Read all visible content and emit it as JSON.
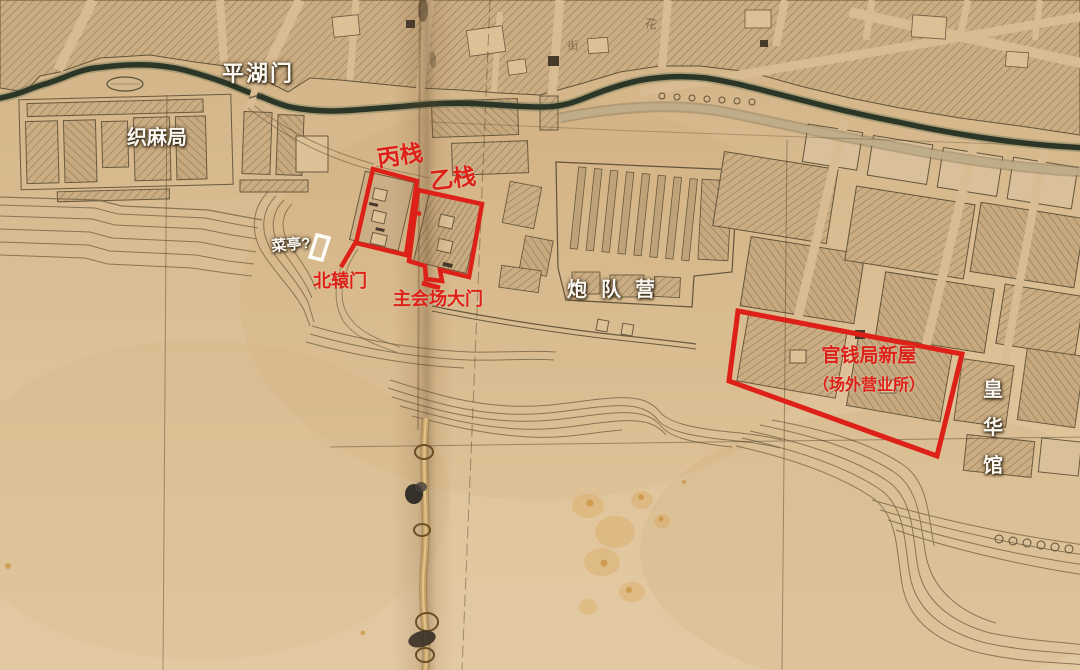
{
  "map": {
    "description": "annotated historical city map (scanned paper map with red exposition-site overlay)",
    "labels": {
      "pinghumen": "平湖门",
      "zhimaju": "织麻局",
      "bingzhan": "丙栈",
      "yizhan": "乙栈",
      "caiting": "菜亭?",
      "beiyuanmen": "北辕门",
      "main_gate": "主会场大门",
      "paoduiying": "炮队营",
      "guanqianju_line1": "官钱局新屋",
      "guanqianju_line2": "（场外营业所）",
      "huanghuaguan": "皇华馆",
      "faint_hua": "花",
      "faint_jie": "街"
    },
    "annotated_sites": [
      {
        "label": "丙栈",
        "marker": "red-outline-box"
      },
      {
        "label": "乙栈",
        "marker": "red-outline-box"
      },
      {
        "label": "官钱局新屋（场外营业所）",
        "marker": "red-outline-box"
      },
      {
        "label": "菜亭?",
        "marker": "white-outline-box"
      },
      {
        "label": "北辕门",
        "marker": "red-pointer-line"
      },
      {
        "label": "主会场大门",
        "marker": "red-pointer-line"
      }
    ],
    "colors": {
      "annotation_red": "#de2118",
      "annotation_white": "#fbf8f1",
      "paper": "#d8ba8e",
      "paper_light": "#e2c79f",
      "river": "#2b3627",
      "map_ink": "#6a5a3e"
    }
  }
}
